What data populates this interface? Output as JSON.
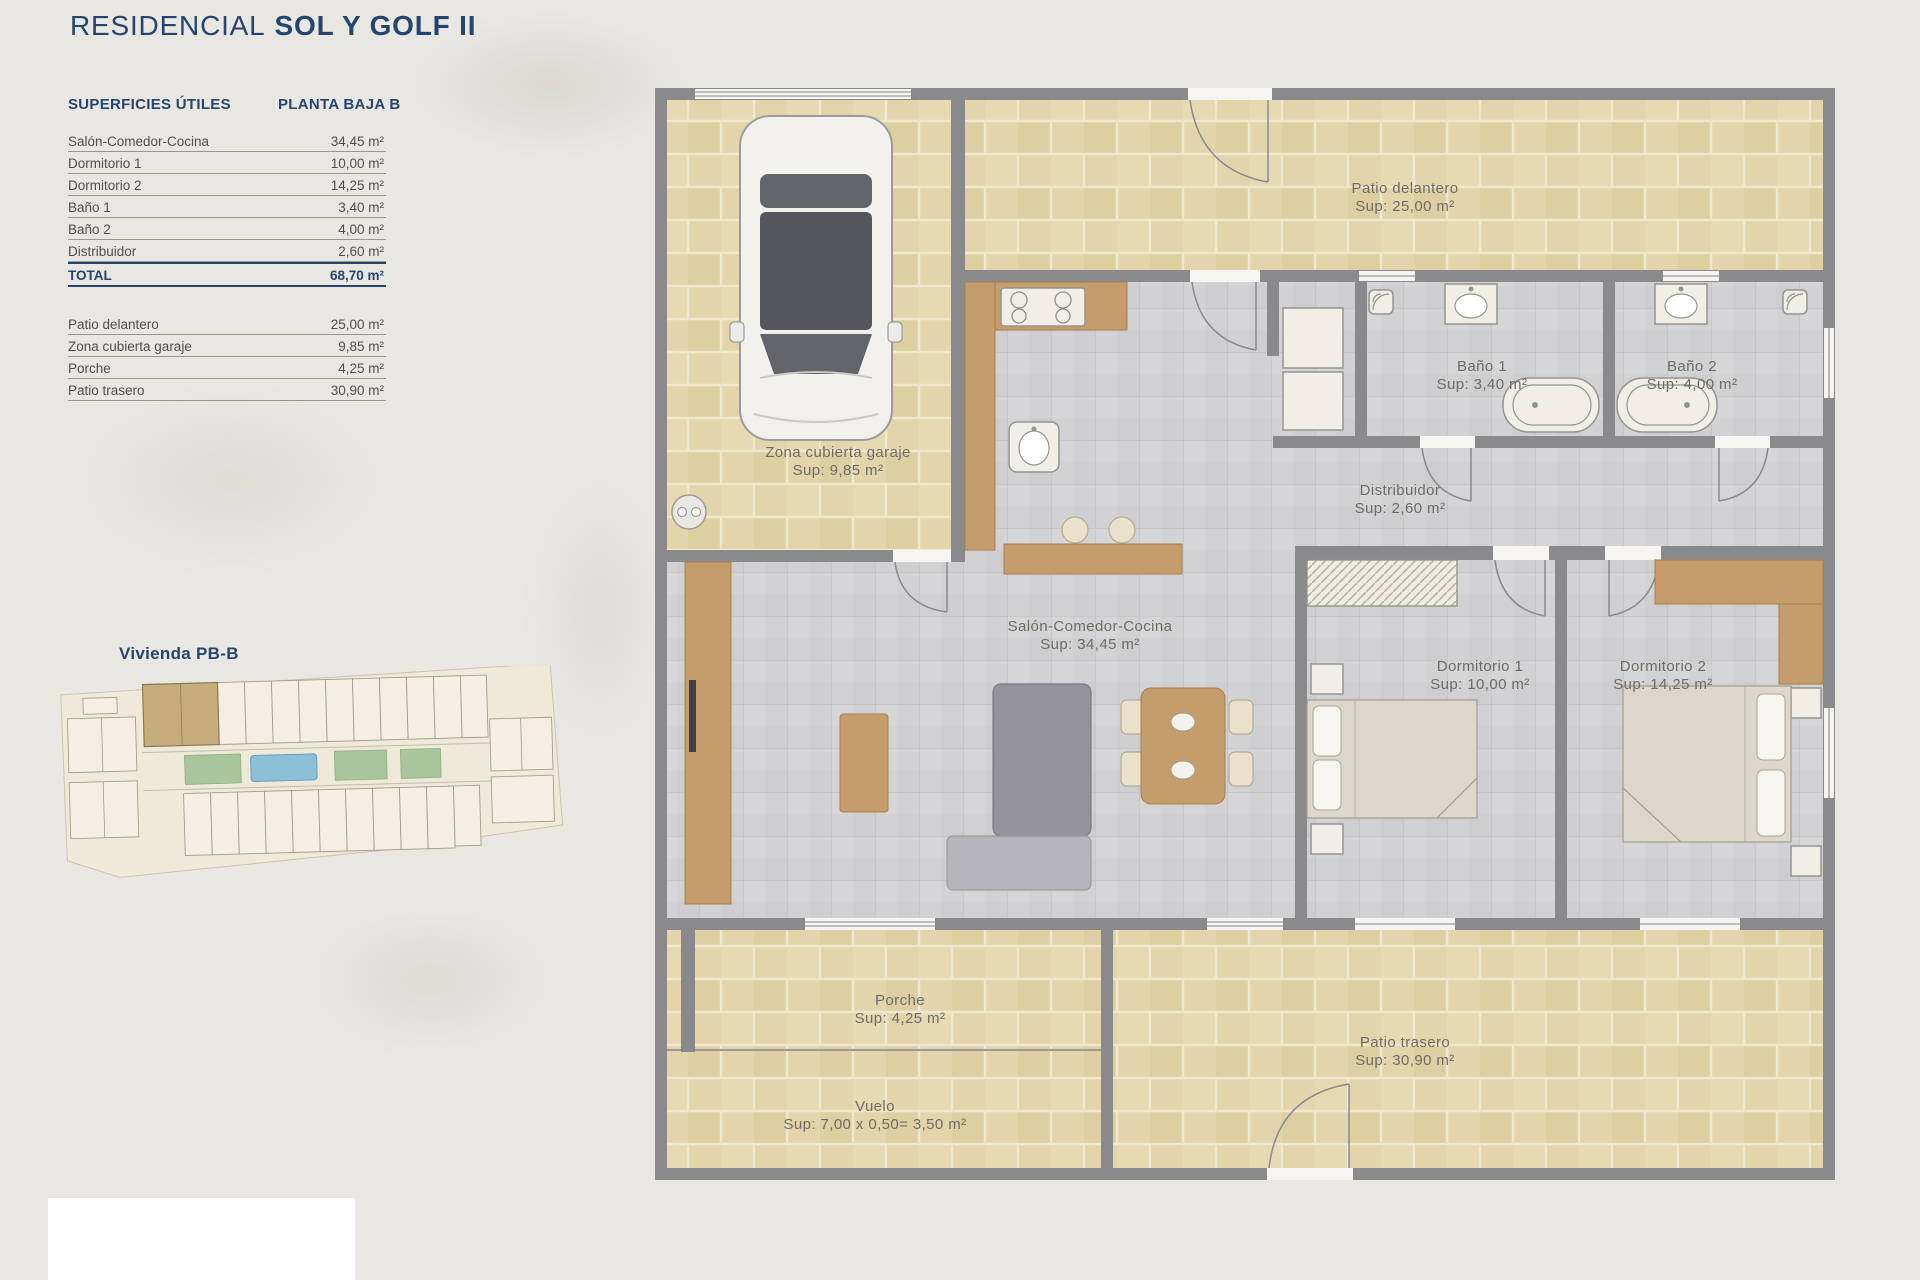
{
  "title": {
    "prefix": "RESIDENCIAL",
    "name": "SOL Y GOLF II"
  },
  "areas_table": {
    "header_left": "SUPERFICIES ÚTILES",
    "header_right": "PLANTA BAJA B",
    "rows": [
      {
        "label": "Salón-Comedor-Cocina",
        "value": "34,45 m²"
      },
      {
        "label": "Dormitorio 1",
        "value": "10,00 m²"
      },
      {
        "label": "Dormitorio 2",
        "value": "14,25 m²"
      },
      {
        "label": "Baño 1",
        "value": "3,40 m²"
      },
      {
        "label": "Baño 2",
        "value": "4,00 m²"
      },
      {
        "label": "Distribuidor",
        "value": "2,60 m²"
      }
    ],
    "total": {
      "label": "TOTAL",
      "value": "68,70 m²"
    },
    "outdoor_rows": [
      {
        "label": "Patio delantero",
        "value": "25,00 m²"
      },
      {
        "label": "Zona cubierta garaje",
        "value": "9,85 m²"
      },
      {
        "label": "Porche",
        "value": "4,25 m²"
      },
      {
        "label": "Patio trasero",
        "value": "30,90 m²"
      }
    ]
  },
  "site_plan": {
    "label": "Vivienda PB-B"
  },
  "floor_plan": {
    "rooms": [
      {
        "name": "Patio delantero",
        "sup": "Sup: 25,00 m²"
      },
      {
        "name": "Baño 1",
        "sup": "Sup: 3,40 m²"
      },
      {
        "name": "Baño 2",
        "sup": "Sup: 4,00 m²"
      },
      {
        "name": "Zona cubierta garaje",
        "sup": "Sup: 9,85 m²"
      },
      {
        "name": "Distribuidor",
        "sup": "Sup: 2,60 m²"
      },
      {
        "name": "Salón-Comedor-Cocina",
        "sup": "Sup: 34,45 m²"
      },
      {
        "name": "Dormitorio 1",
        "sup": "Sup: 10,00 m²"
      },
      {
        "name": "Dormitorio 2",
        "sup": "Sup: 14,25 m²"
      },
      {
        "name": "Porche",
        "sup": "Sup: 4,25 m²"
      },
      {
        "name": "Patio trasero",
        "sup": "Sup: 30,90 m²"
      },
      {
        "name": "Vuelo",
        "sup": "Sup: 7,00 x 0,50= 3,50 m²"
      }
    ]
  },
  "colors": {
    "accent_navy": "#26456e",
    "patio_beige": "#e3d4ab",
    "tile_gray": "#d2d2d4",
    "wall_gray": "#8a8a8d",
    "wood": "#c59c6b",
    "pool_blue": "#8cc0d8"
  }
}
